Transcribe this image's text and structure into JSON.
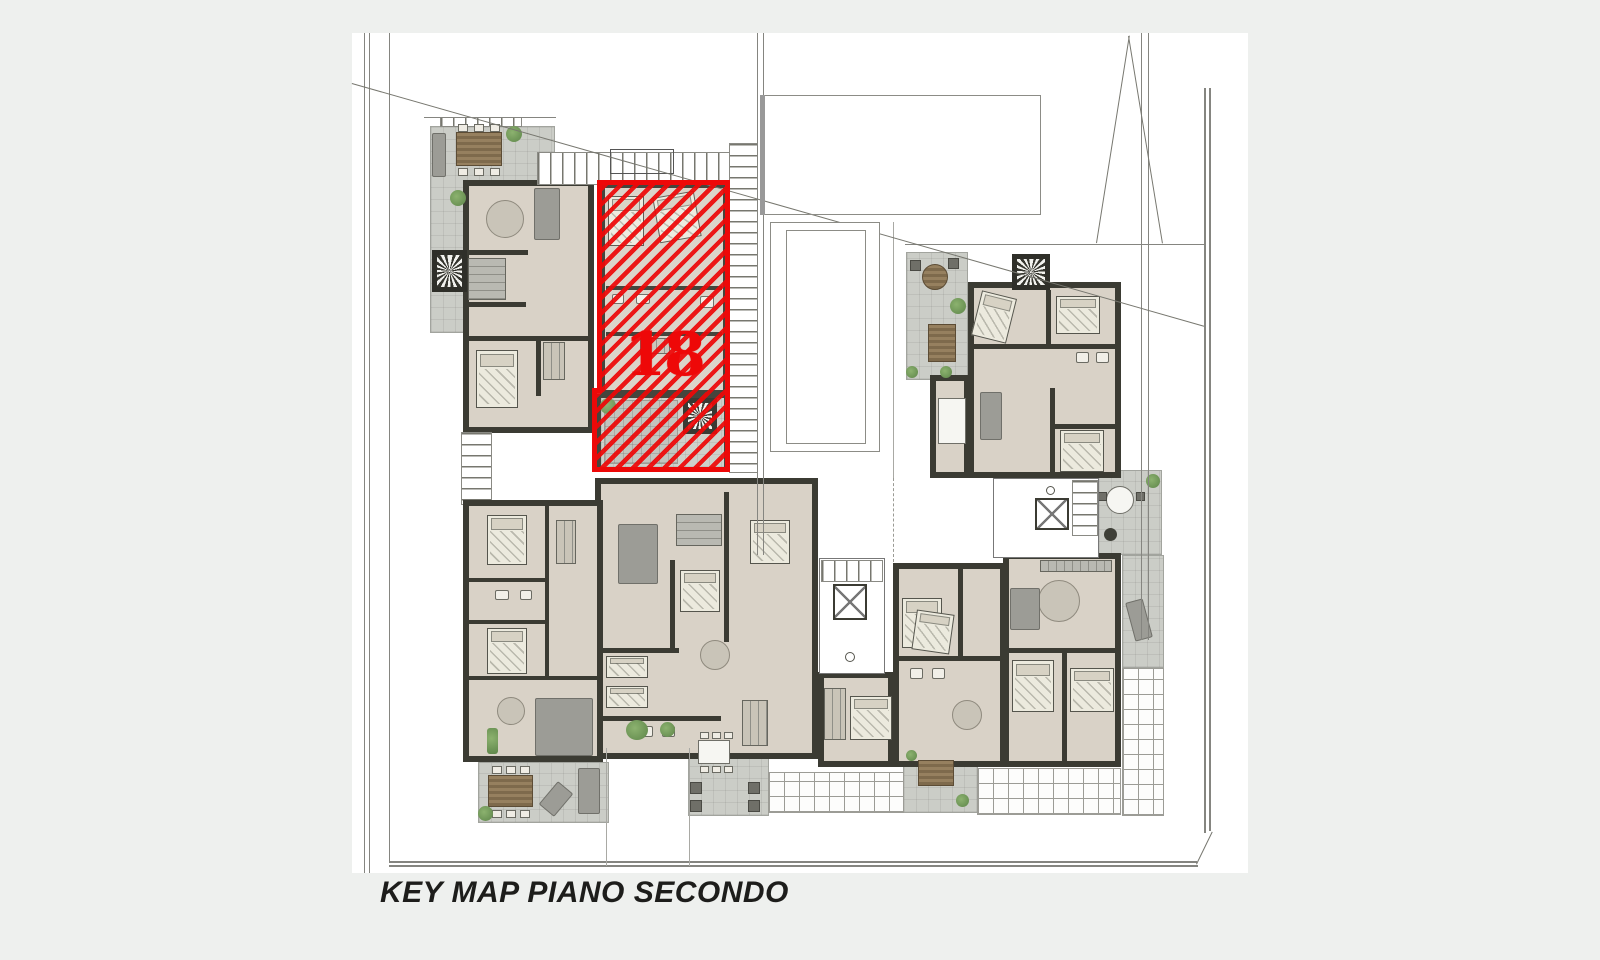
{
  "caption": {
    "text": "KEY MAP PIANO SECONDO"
  },
  "unit": {
    "label": "18"
  },
  "palette": {
    "background": "#eef0ee",
    "sheet": "#ffffff",
    "wall": "#3b3b33",
    "floor": "#d9d2c7",
    "terrace": "#cbcdc7",
    "highlight_red": "#ee0808",
    "caption_ink": "#1d1d1b",
    "site_line": "#858580",
    "plant_green": "#6f9a5d",
    "wood": "#8a7458"
  }
}
